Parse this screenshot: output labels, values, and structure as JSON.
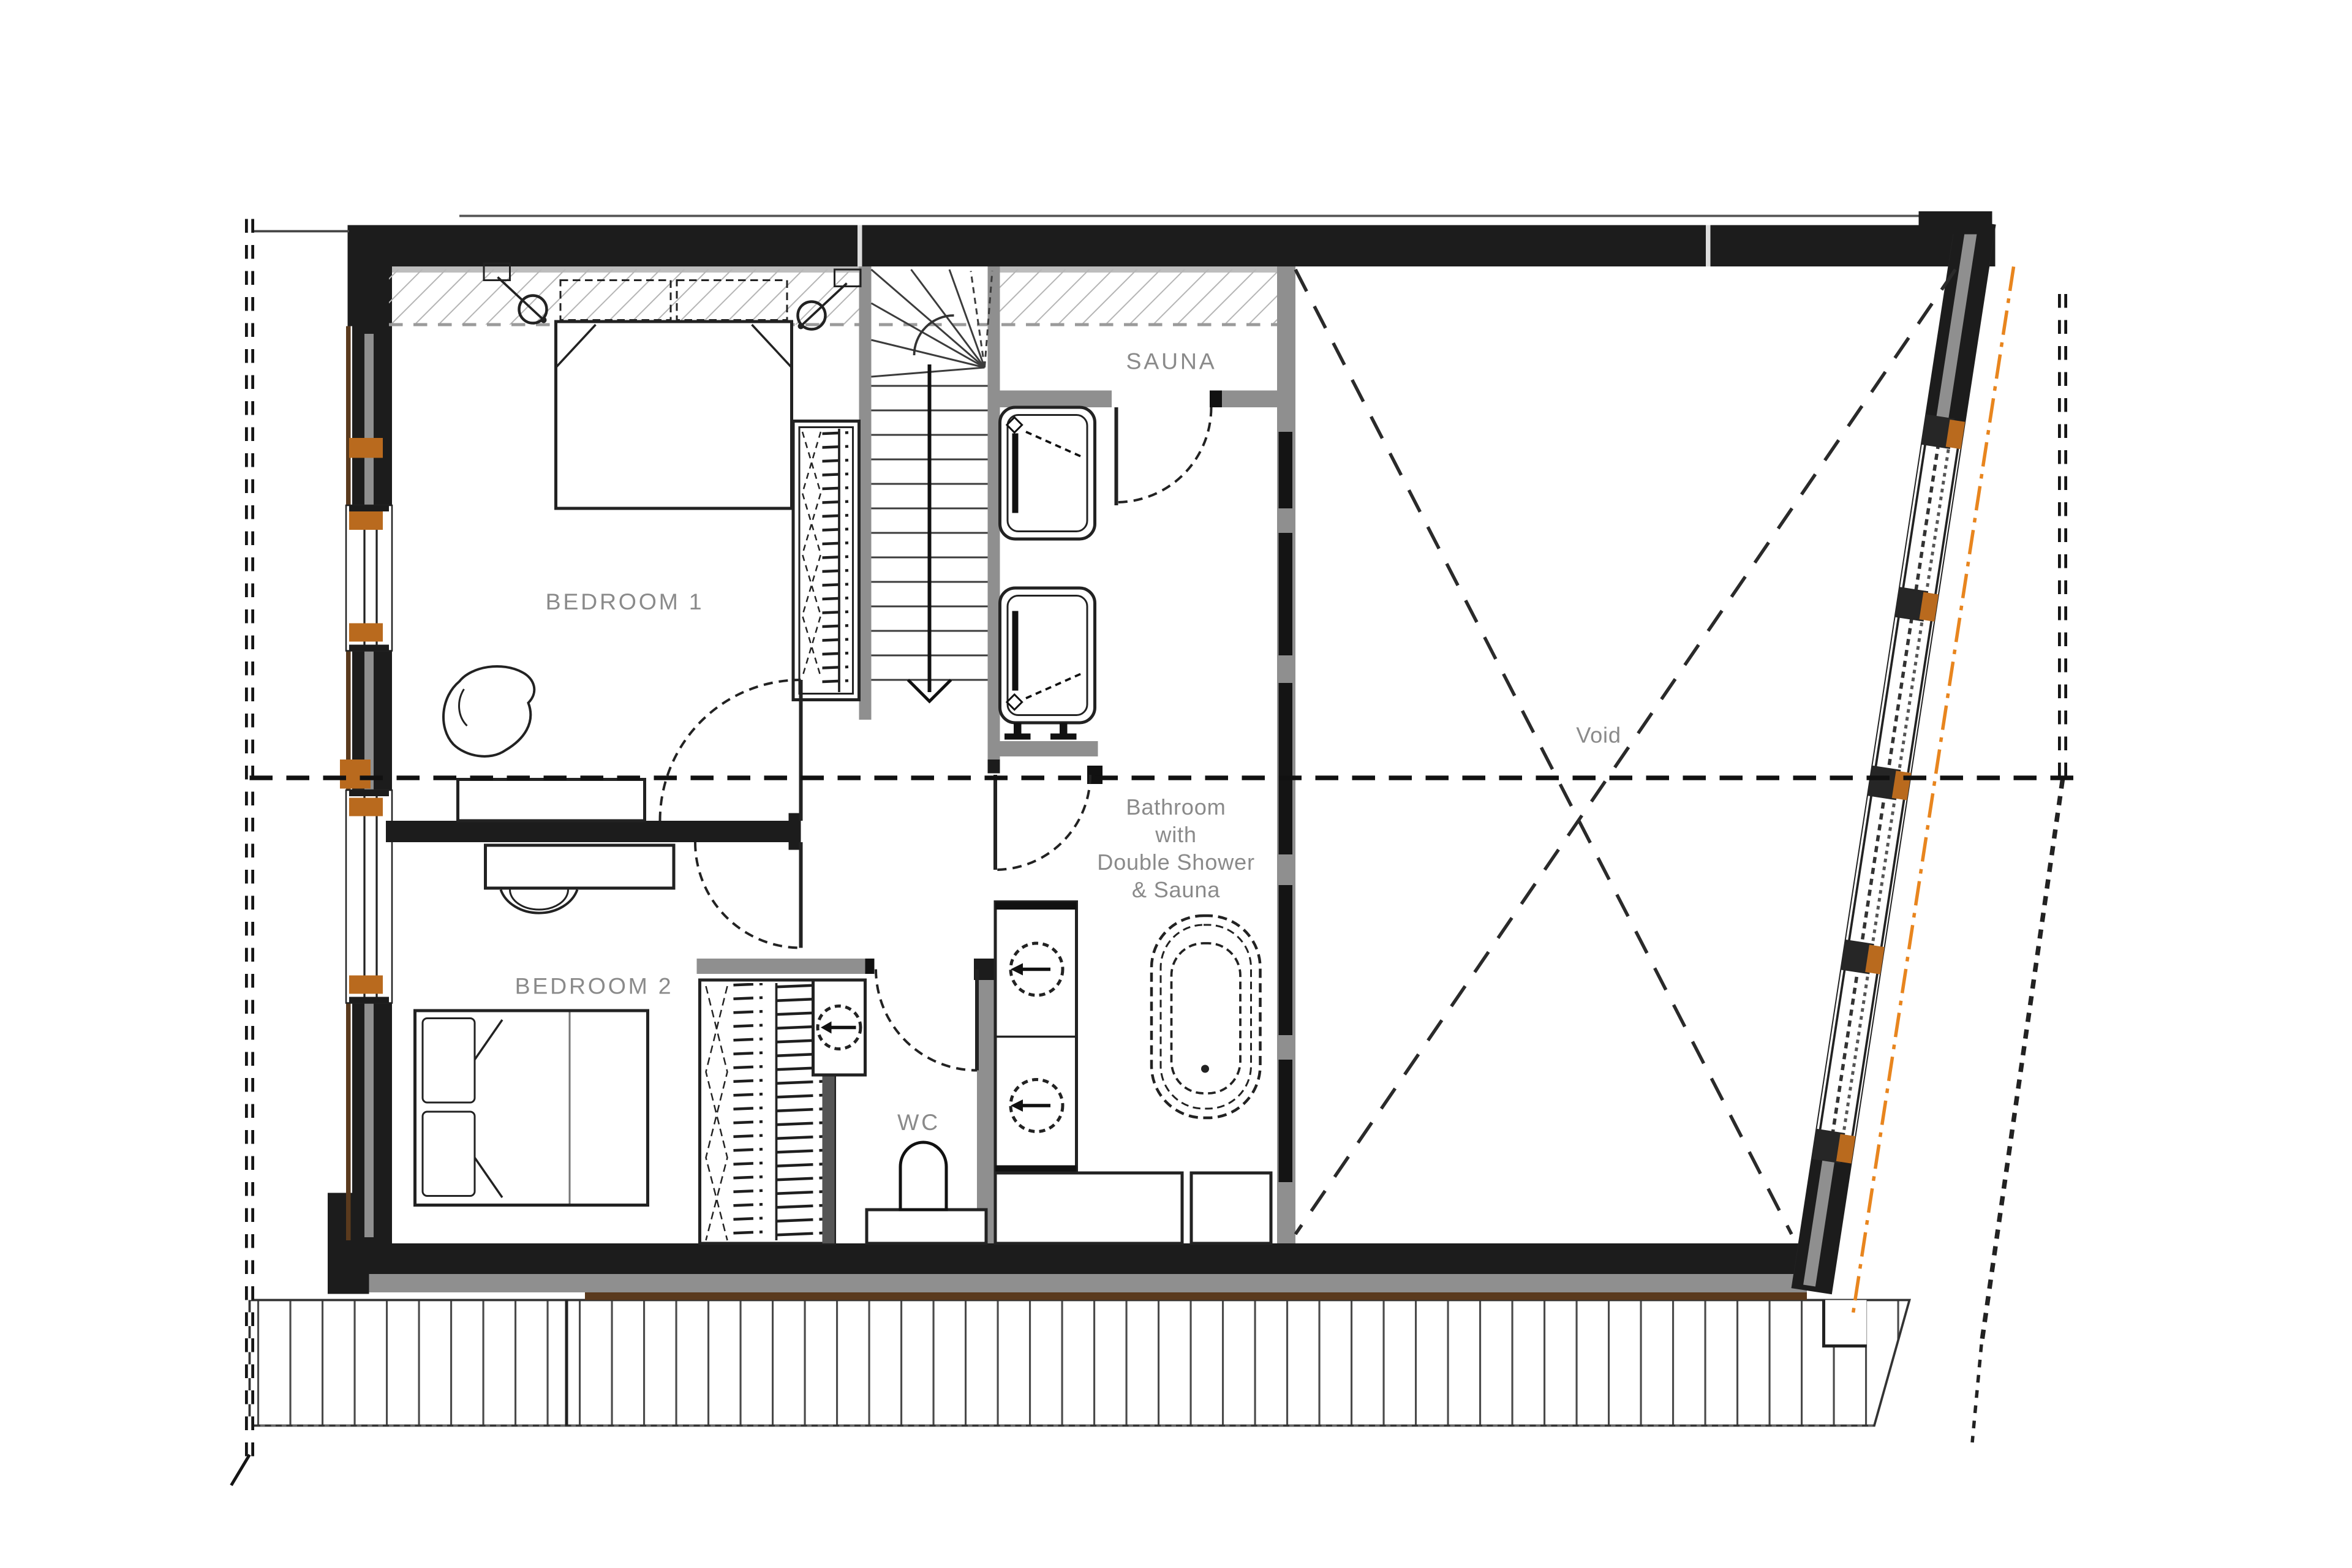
{
  "plan": {
    "rooms": {
      "sauna": {
        "label": "SAUNA"
      },
      "bedroom1": {
        "label": "BEDROOM 1"
      },
      "bedroom2": {
        "label": "BEDROOM 2"
      },
      "wc": {
        "label": "WC"
      },
      "bathroom": {
        "lines": [
          "Bathroom",
          "with",
          "Double Shower",
          "& Sauna"
        ]
      },
      "void": {
        "label": "Void"
      }
    },
    "colors": {
      "wall": "#1c1c1c",
      "wall_gray": "#8f8f8f",
      "liner_gray": "#bdbdbd",
      "accent_orange": "#b96a1e",
      "dashdot_orange": "#e8851e",
      "wood_brown": "#5a3a1d",
      "label_gray": "#8a8a8a",
      "hatch_gray": "#b5b5b5",
      "line_dark": "#222222"
    }
  }
}
